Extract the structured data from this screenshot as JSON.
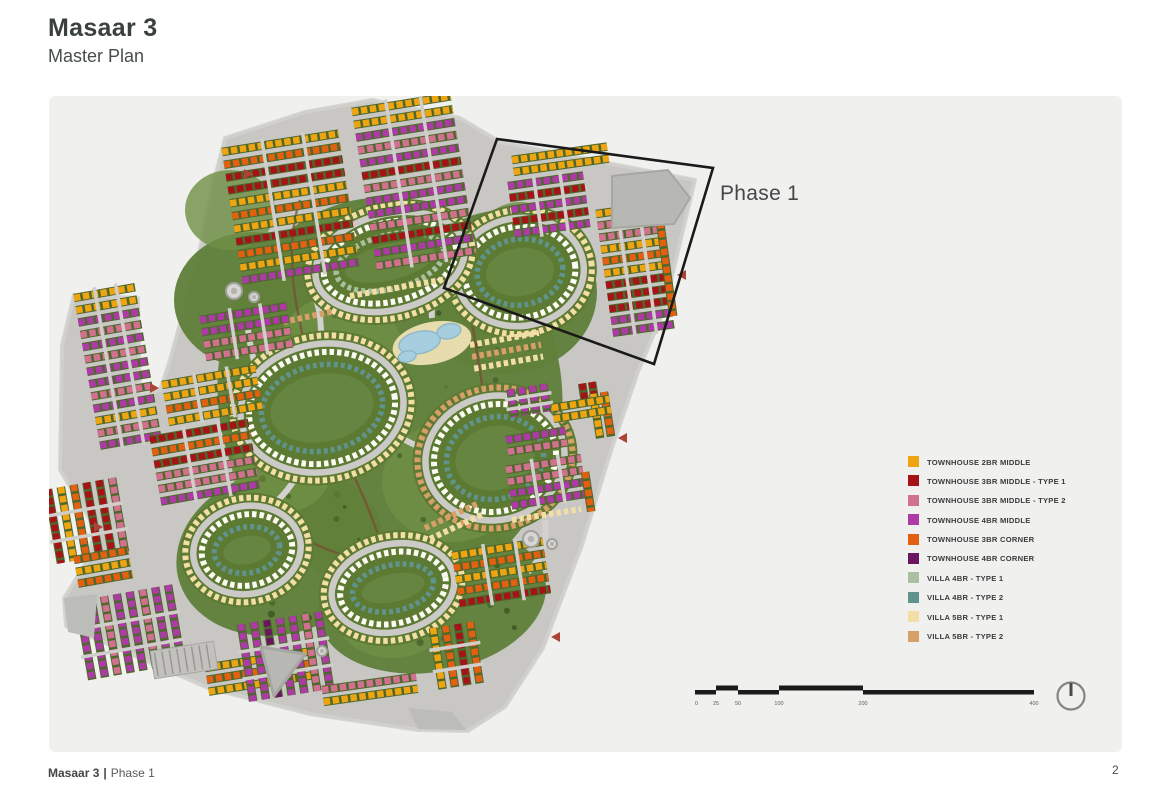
{
  "header": {
    "title": "Masaar 3",
    "subtitle": "Master Plan"
  },
  "map": {
    "phase_label": "Phase 1",
    "colors": {
      "panel_bg": "#f0f0ef",
      "road": "#c8c7c4",
      "road_light": "#d2d1ce",
      "green": "#61803a",
      "green_light": "#6f9045",
      "green_dark": "#46622a",
      "hedge": "#4d682c",
      "villa_white": "#fbfaf3",
      "water": "#a6cede",
      "water_edge": "#8fb9cb",
      "sand": "#e7dcae",
      "facility": "#b7b7b4",
      "phase_outline": "#1a1a1a",
      "entry_marker": "#ad4336",
      "path_brown": "#7b4a33"
    }
  },
  "legend": {
    "items": [
      {
        "label": "TOWNHOUSE 2BR MIDDLE",
        "color": "#EFA512"
      },
      {
        "label": "TOWNHOUSE 3BR MIDDLE - TYPE 1",
        "color": "#A61317"
      },
      {
        "label": "TOWNHOUSE 3BR MIDDLE - TYPE 2",
        "color": "#D1718F"
      },
      {
        "label": "TOWNHOUSE 4BR MIDDLE",
        "color": "#AD3AA5"
      },
      {
        "label": "TOWNHOUSE 3BR CORNER",
        "color": "#E2600F"
      },
      {
        "label": "TOWNHOUSE 4BR CORNER",
        "color": "#6B1562"
      },
      {
        "label": "VILLA 4BR - TYPE 1",
        "color": "#A9BFA0"
      },
      {
        "label": "VILLA 4BR - TYPE 2",
        "color": "#5F938B"
      },
      {
        "label": "VILLA 5BR - TYPE 1",
        "color": "#F3DFA6"
      },
      {
        "label": "VILLA 5BR - TYPE 2",
        "color": "#D7A068"
      }
    ]
  },
  "scale_bar": {
    "labels": [
      "0",
      "25",
      "50",
      "100",
      "200",
      "400"
    ]
  },
  "north_indicator": {
    "icon": "north-arrow-icon"
  },
  "footer": {
    "project": "Masaar 3",
    "separator": "|",
    "section": "Phase 1",
    "page_number": "2"
  }
}
